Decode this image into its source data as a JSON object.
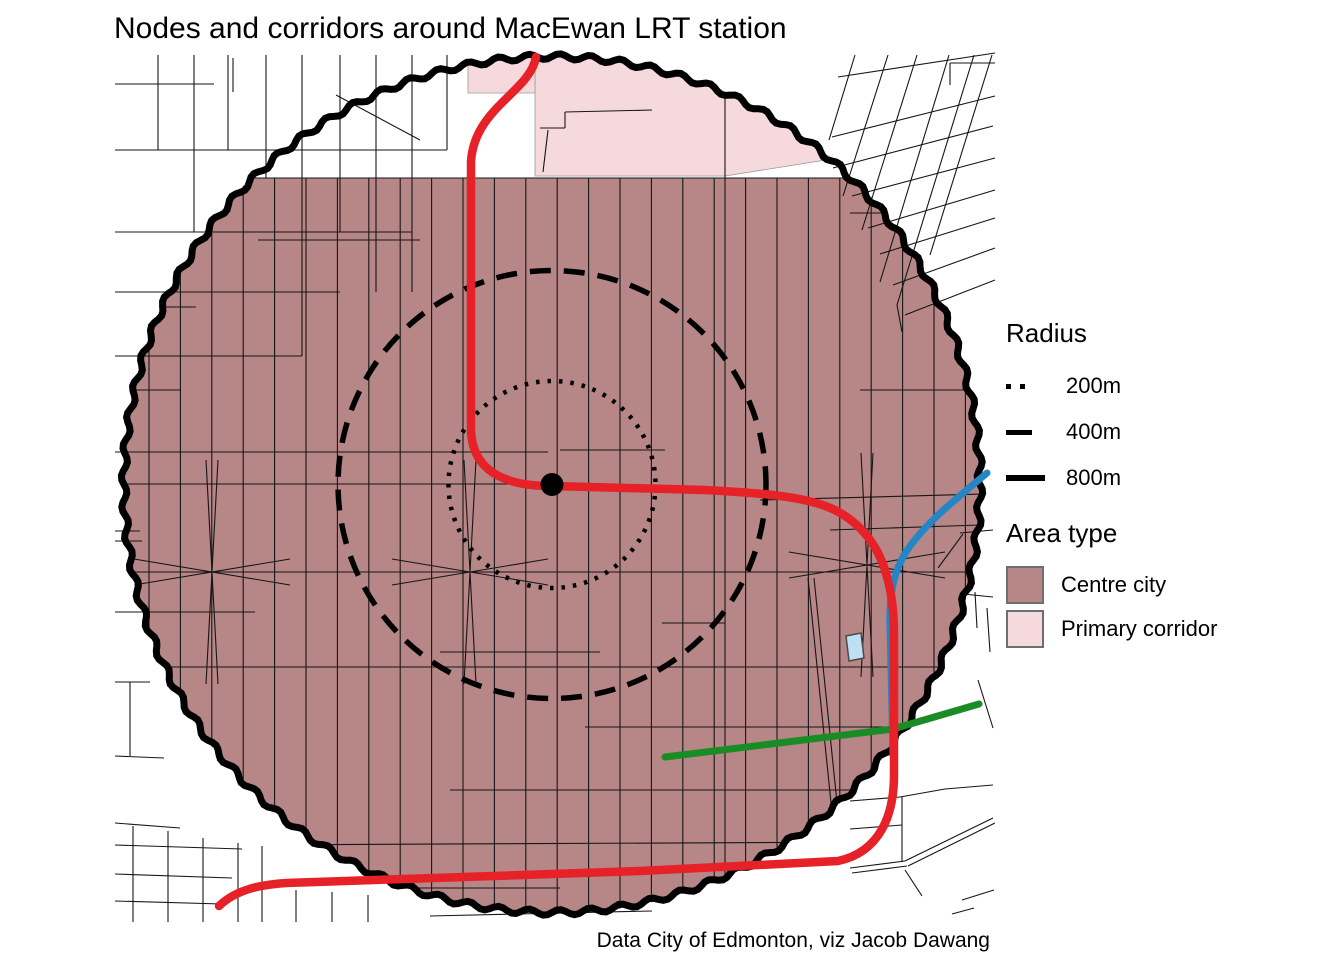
{
  "title": "Nodes and corridors around MacEwan LRT station",
  "caption": "Data City of Edmonton, viz Jacob Dawang",
  "legend_radius": {
    "title": "Radius",
    "items": [
      {
        "label": "200m",
        "style": "dotted"
      },
      {
        "label": "400m",
        "style": "dashed"
      },
      {
        "label": "800m",
        "style": "solid"
      }
    ]
  },
  "legend_area": {
    "title": "Area type",
    "items": [
      {
        "label": "Centre city",
        "key": "centre_city",
        "color": "#b78687"
      },
      {
        "label": "Primary corridor",
        "key": "primary_corridor",
        "color": "#f6d9dc"
      }
    ]
  },
  "map": {
    "width": 1344,
    "height": 960,
    "station_name": "MacEwan LRT station",
    "center": {
      "x": 552,
      "y": 484.5
    },
    "station_dot_radius": 11.5,
    "rings": [
      {
        "label": "200m",
        "radius_px": 103.5,
        "radius_m": 200,
        "style": "dotted"
      },
      {
        "label": "400m",
        "radius_px": 214,
        "radius_m": 400,
        "style": "dashed"
      },
      {
        "label": "800m",
        "radius_px": 428,
        "radius_m": 800,
        "style": "solid"
      }
    ],
    "colors": {
      "background": "#ffffff",
      "centre_city": "#b78687",
      "primary_corridor": "#f6d9dc",
      "street": "#161616",
      "ring": "#000000",
      "red_route": "#e62128",
      "blue_route": "#2486c4",
      "green_route": "#1a8c26",
      "water_fill": "#bfe0f2",
      "water_stroke": "#4a4a4a"
    },
    "area_top_y": 178,
    "primary_corridor_polys": [
      [
        [
          535,
          45
        ],
        [
          815,
          45
        ],
        [
          838,
          158
        ],
        [
          725,
          176
        ],
        [
          535,
          176
        ]
      ],
      [
        [
          468,
          45
        ],
        [
          535,
          45
        ],
        [
          535,
          93
        ],
        [
          468,
          93
        ]
      ]
    ],
    "routes": [
      {
        "name": "blue-lrt-line",
        "color_key": "blue_route",
        "width": 7,
        "d": "M987,473 C955,500 925,523 906,552 C893,572 889,597 890,625 L893,755"
      },
      {
        "name": "green-route-line",
        "color_key": "green_route",
        "width": 7,
        "d": "M665,757 L893,729 L979,704"
      },
      {
        "name": "red-lrt-line",
        "color_key": "red_route",
        "width": 8.5,
        "d": "M536,57 C530,92 474,108 471,162 L471,428 C471,462 492,486 551,486 L705,490 C760,493 800,496 828,507 C858,519 879,545 887,577 C893,598 894,618 894,640 L894,775 C894,815 880,852 838,861 L640,871 L286,883 C258,885 236,890 219,906"
      }
    ],
    "building": [
      [
        846,
        636
      ],
      [
        861,
        633
      ],
      [
        864,
        658
      ],
      [
        849,
        661
      ]
    ],
    "streets": {
      "inside_vertical": {
        "x0": 149,
        "step": 31.4,
        "count": 27,
        "y0": 178,
        "y1": 922
      },
      "inside_segments": [
        [
          124,
          178,
          980,
          178
        ],
        [
          258,
          240,
          420,
          240
        ],
        [
          850,
          213,
          980,
          213
        ],
        [
          124,
          307,
          196,
          307
        ],
        [
          124,
          390,
          180,
          390
        ],
        [
          124,
          452,
          548,
          452
        ],
        [
          860,
          390,
          980,
          390
        ],
        [
          560,
          450,
          665,
          450
        ],
        [
          124,
          484,
          545,
          484
        ],
        [
          760,
          500,
          985,
          494
        ],
        [
          124,
          572,
          980,
          572
        ],
        [
          124,
          667,
          980,
          667
        ],
        [
          585,
          727,
          980,
          727
        ],
        [
          450,
          790,
          905,
          790
        ],
        [
          235,
          845,
          880,
          842
        ],
        [
          256,
          888,
          560,
          888
        ],
        [
          440,
          652,
          600,
          652
        ],
        [
          662,
          623,
          725,
          623
        ],
        [
          725,
          96,
          725,
          920
        ],
        [
          808,
          578,
          843,
          920
        ],
        [
          814,
          578,
          849,
          920
        ],
        [
          540,
          128,
          565,
          128
        ],
        [
          565,
          112,
          565,
          128
        ],
        [
          565,
          112,
          652,
          110
        ],
        [
          543,
          172,
          548,
          130
        ],
        [
          830,
          530,
          980,
          525
        ],
        [
          124,
          612,
          255,
          612
        ]
      ],
      "spikes": [
        [
          212,
          572
        ],
        [
          470,
          572
        ],
        [
          867,
          565
        ]
      ],
      "outside_segments": [
        [
          115,
          84,
          214,
          84
        ],
        [
          115,
          150,
          447,
          150
        ],
        [
          115,
          232,
          412,
          232
        ],
        [
          115,
          292,
          340,
          292
        ],
        [
          115,
          356,
          302,
          356
        ],
        [
          158,
          55,
          158,
          150
        ],
        [
          194,
          55,
          194,
          232
        ],
        [
          228,
          55,
          228,
          150
        ],
        [
          233,
          58,
          233,
          92
        ],
        [
          266,
          55,
          266,
          178
        ],
        [
          302,
          55,
          302,
          356
        ],
        [
          340,
          55,
          340,
          232
        ],
        [
          376,
          55,
          376,
          292
        ],
        [
          412,
          55,
          412,
          292
        ],
        [
          447,
          55,
          447,
          150
        ],
        [
          336,
          95,
          420,
          140
        ],
        [
          838,
          77,
          995,
          53
        ],
        [
          832,
          137,
          995,
          96
        ],
        [
          833,
          168,
          993,
          126
        ],
        [
          852,
          196,
          995,
          158
        ],
        [
          868,
          228,
          995,
          190
        ],
        [
          880,
          254,
          995,
          218
        ],
        [
          893,
          285,
          995,
          248
        ],
        [
          905,
          315,
          995,
          280
        ],
        [
          855,
          55,
          829,
          140
        ],
        [
          888,
          55,
          843,
          196
        ],
        [
          917,
          55,
          862,
          230
        ],
        [
          949,
          55,
          880,
          282
        ],
        [
          974,
          55,
          897,
          305
        ],
        [
          992,
          55,
          930,
          255
        ],
        [
          950,
          63,
          995,
          63
        ],
        [
          950,
          63,
          950,
          85
        ],
        [
          897,
          305,
          902,
          332
        ],
        [
          938,
          568,
          963,
          534
        ],
        [
          960,
          533,
          993,
          530
        ],
        [
          963,
          594,
          993,
          597
        ],
        [
          975,
          592,
          977,
          628
        ],
        [
          987,
          608,
          990,
          652
        ],
        [
          978,
          680,
          993,
          728
        ],
        [
          850,
          801,
          900,
          797
        ],
        [
          900,
          797,
          945,
          789
        ],
        [
          945,
          789,
          993,
          785
        ],
        [
          850,
          829,
          902,
          825
        ],
        [
          850,
          868,
          905,
          861
        ],
        [
          852,
          873,
          907,
          866
        ],
        [
          905,
          861,
          993,
          818
        ],
        [
          908,
          866,
          995,
          823
        ],
        [
          902,
          797,
          902,
          862
        ],
        [
          905,
          870,
          922,
          896
        ],
        [
          962,
          900,
          994,
          890
        ],
        [
          952,
          914,
          974,
          908
        ],
        [
          430,
          916,
          652,
          911
        ],
        [
          296,
          890,
          296,
          922
        ],
        [
          332,
          892,
          332,
          922
        ],
        [
          368,
          895,
          368,
          922
        ],
        [
          133,
          826,
          133,
          922
        ],
        [
          168,
          831,
          168,
          922
        ],
        [
          203,
          838,
          203,
          922
        ],
        [
          238,
          843,
          238,
          922
        ],
        [
          262,
          846,
          262,
          922
        ],
        [
          115,
          845,
          242,
          849
        ],
        [
          115,
          874,
          232,
          878
        ],
        [
          115,
          901,
          222,
          904
        ],
        [
          115,
          823,
          180,
          828
        ],
        [
          115,
          452,
          152,
          452
        ],
        [
          115,
          531,
          140,
          531
        ],
        [
          115,
          541,
          142,
          541
        ],
        [
          115,
          612,
          146,
          612
        ],
        [
          115,
          682,
          150,
          682
        ],
        [
          130,
          682,
          130,
          756
        ],
        [
          115,
          756,
          164,
          758
        ]
      ]
    }
  }
}
